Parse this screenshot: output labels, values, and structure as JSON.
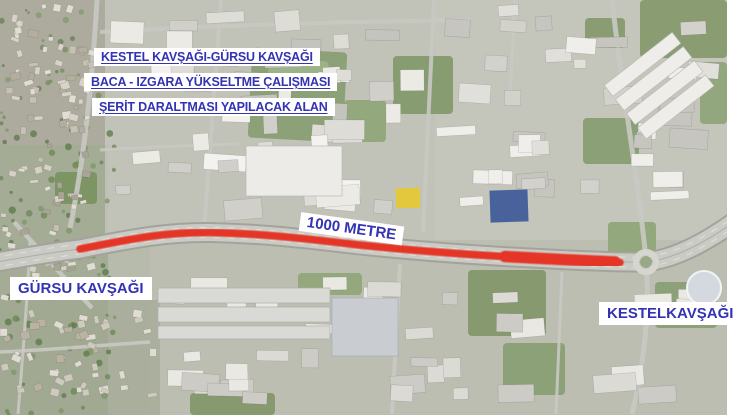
{
  "map": {
    "title_lines": [
      "KESTEL KAVŞAĞI-GÜRSU KAVŞAĞI",
      "BACA - IZGARA YÜKSELTME ÇALIŞMASI",
      "ŞERİT DARALTMASI YAPILACAK ALAN"
    ],
    "distance_label": "1000 METRE",
    "left_junction_label": "GÜRSU KAVŞAĞI",
    "right_junction_label": "KESTELKAVŞAĞI",
    "colors": {
      "label_text": "#3333b3",
      "label_bg": "#ffffff",
      "highlight_road": "#e53527"
    }
  }
}
